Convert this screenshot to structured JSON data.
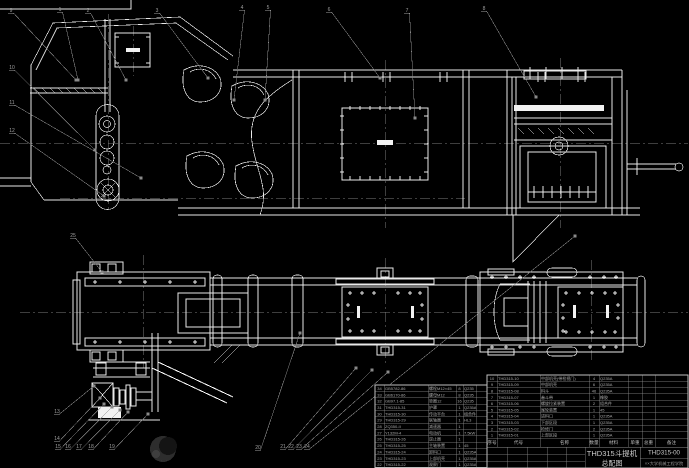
{
  "title_block": {
    "product": "THD315斗提机",
    "sheet": "总配图",
    "number": "THD315-00",
    "org": "××大学机械工程学院"
  },
  "bom_right": {
    "headers": [
      "序号",
      "代号",
      "名称",
      "数量",
      "材料",
      "单重",
      "总重",
      "备注"
    ],
    "rows": [
      [
        "10",
        "THD315-10",
        "中部机壳(带检视门)",
        "4",
        "Q235A",
        "",
        "",
        ""
      ],
      [
        "9",
        "THD315-09",
        "中部机壳",
        "6",
        "Q235A",
        "",
        "",
        ""
      ],
      [
        "8",
        "THD315-08",
        "料斗",
        "46",
        "Q235A",
        "",
        "",
        ""
      ],
      [
        "7",
        "THD315-07",
        "畚斗带",
        "1",
        "橡胶",
        "",
        "",
        ""
      ],
      [
        "6",
        "THD315-06",
        "螺旋拉紧装置",
        "2",
        "组合件",
        "",
        "",
        ""
      ],
      [
        "5",
        "THD315-05",
        "尾轮装置",
        "1",
        "45",
        "",
        "",
        ""
      ],
      [
        "4",
        "THD315-04",
        "进料口",
        "1",
        "Q235A",
        "",
        "",
        ""
      ],
      [
        "3",
        "THD315-03",
        "下部区段",
        "1",
        "Q235A",
        "",
        "",
        ""
      ],
      [
        "2",
        "THD315-02",
        "检修门",
        "2",
        "Q235A",
        "",
        "",
        ""
      ],
      [
        "1",
        "THD315-01",
        "上部区段",
        "1",
        "Q235A",
        "",
        "",
        ""
      ]
    ]
  },
  "bom_left": {
    "rows": [
      [
        "34",
        "GB5782-86",
        "螺栓M12×45",
        "8",
        "Q235",
        ""
      ],
      [
        "33",
        "GB6170-86",
        "螺母M12",
        "8",
        "Q235",
        ""
      ],
      [
        "32",
        "GB97.1-85",
        "垫圈12",
        "16",
        "Q235",
        ""
      ],
      [
        "31",
        "THD315-31",
        "护罩",
        "1",
        "Q235A",
        ""
      ],
      [
        "30",
        "THD315-30",
        "传动平台",
        "1",
        "组合件",
        ""
      ],
      [
        "29",
        "THD315-29",
        "联轴器",
        "1",
        "HL3",
        ""
      ],
      [
        "28",
        "ZQ350-II",
        "减速器",
        "1",
        "",
        ""
      ],
      [
        "27",
        "Y132M-4",
        "电动机",
        "1",
        "7.5kW",
        ""
      ],
      [
        "26",
        "THD315-26",
        "逆止器",
        "1",
        "",
        ""
      ],
      [
        "25",
        "THD315-25",
        "主轴装置",
        "1",
        "45",
        ""
      ],
      [
        "24",
        "THD315-24",
        "卸料口",
        "1",
        "Q235A",
        ""
      ],
      [
        "23",
        "THD315-23",
        "上部机壳",
        "1",
        "Q235A",
        ""
      ],
      [
        "22",
        "THD315-22",
        "观察门",
        "1",
        "Q235A",
        ""
      ]
    ]
  },
  "callouts": [
    {
      "n": "1",
      "x": 60,
      "y": 8,
      "ex": 78,
      "ey": 80
    },
    {
      "n": "2",
      "x": 88,
      "y": 9,
      "ex": 126,
      "ey": 80
    },
    {
      "n": "3",
      "x": 157,
      "y": 9,
      "ex": 208,
      "ey": 78
    },
    {
      "n": "4",
      "x": 242,
      "y": 6,
      "ex": 234,
      "ey": 100
    },
    {
      "n": "5",
      "x": 268,
      "y": 6,
      "ex": 265,
      "ey": 100
    },
    {
      "n": "6",
      "x": 329,
      "y": 8,
      "ex": 380,
      "ey": 78
    },
    {
      "n": "7",
      "x": 407,
      "y": 9,
      "ex": 415,
      "ey": 118
    },
    {
      "n": "8",
      "x": 484,
      "y": 7,
      "ex": 536,
      "ey": 97
    },
    {
      "n": "9",
      "x": 11,
      "y": 9,
      "ex": 76,
      "ey": 80
    },
    {
      "n": "10",
      "x": 12,
      "y": 66,
      "ex": 95,
      "ey": 150
    },
    {
      "n": "11",
      "x": 12,
      "y": 101,
      "ex": 141,
      "ey": 178
    },
    {
      "n": "12",
      "x": 12,
      "y": 129,
      "ex": 104,
      "ey": 196
    },
    {
      "n": "13",
      "x": 57,
      "y": 410,
      "ex": 94,
      "ey": 386
    },
    {
      "n": "14",
      "x": 57,
      "y": 437,
      "ex": 100,
      "ey": 398
    },
    {
      "n": "15",
      "x": 58,
      "y": 445,
      "ex": 104,
      "ey": 404
    },
    {
      "n": "16",
      "x": 68,
      "y": 445,
      "ex": 112,
      "ey": 407
    },
    {
      "n": "17",
      "x": 79,
      "y": 445,
      "ex": 120,
      "ey": 410
    },
    {
      "n": "18",
      "x": 91,
      "y": 445,
      "ex": 128,
      "ey": 412
    },
    {
      "n": "19",
      "x": 112,
      "y": 445,
      "ex": 148,
      "ey": 414
    },
    {
      "n": "20",
      "x": 258,
      "y": 446,
      "ex": 300,
      "ey": 333
    },
    {
      "n": "21",
      "x": 283,
      "y": 445,
      "ex": 356,
      "ey": 368
    },
    {
      "n": "22",
      "x": 291,
      "y": 445,
      "ex": 372,
      "ey": 370
    },
    {
      "n": "23",
      "x": 299,
      "y": 445,
      "ex": 388,
      "ey": 372
    },
    {
      "n": "24",
      "x": 307,
      "y": 445,
      "ex": 575,
      "ey": 236
    },
    {
      "n": "25",
      "x": 73,
      "y": 234,
      "ex": 102,
      "ey": 272
    }
  ],
  "colors": {
    "background": "#000000",
    "line": "#e9e9e9",
    "leader": "#8a8a8a",
    "table_text": "#aaaaaa",
    "title_text": "#cccccc"
  }
}
